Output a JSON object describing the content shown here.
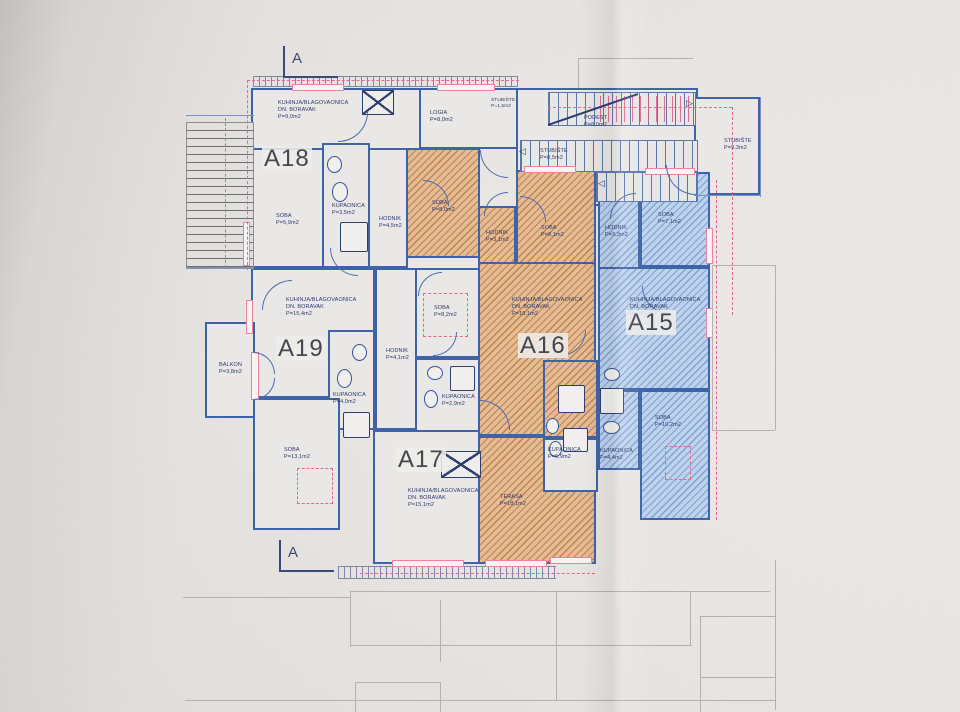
{
  "document": {
    "type": "architectural floor plan (photo of printed drawing)",
    "section_marker_top": "A",
    "section_marker_bottom": "A",
    "apartment_ids": [
      "A15",
      "A16",
      "A17",
      "A18",
      "A19"
    ]
  },
  "colors": {
    "wall": "#3f63a8",
    "line": "#4a6fae",
    "orange_fill": "#e4bd96",
    "orange_stripe": "#c4824f",
    "blue_fill": "#bfd2ec",
    "blue_stripe": "#7fa3d2",
    "pink": "#e8849f",
    "text": "#2c3a6e",
    "big_label": "#43474e",
    "paper": "#eae7e4"
  },
  "plan": {
    "rooms": [
      {
        "n": "a18-kuhinja",
        "x": 251,
        "y": 88,
        "w": 170,
        "h": 62,
        "f": "w"
      },
      {
        "n": "logia",
        "x": 419,
        "y": 88,
        "w": 100,
        "h": 61,
        "f": "w"
      },
      {
        "n": "a18-soba",
        "x": 251,
        "y": 148,
        "w": 73,
        "h": 120,
        "f": "w"
      },
      {
        "n": "a18-kupaonica",
        "x": 322,
        "y": 143,
        "w": 48,
        "h": 125,
        "f": "w"
      },
      {
        "n": "a18-hodnik",
        "x": 368,
        "y": 148,
        "w": 40,
        "h": 120,
        "f": "w"
      },
      {
        "n": "stair-hall",
        "x": 516,
        "y": 88,
        "w": 182,
        "h": 118,
        "f": "w"
      },
      {
        "n": "stubiste-right",
        "x": 694,
        "y": 97,
        "w": 66,
        "h": 98,
        "f": "w"
      },
      {
        "n": "soba-8-0",
        "x": 406,
        "y": 148,
        "w": 74,
        "h": 110,
        "f": "o"
      },
      {
        "n": "a16-hodnik",
        "x": 478,
        "y": 206,
        "w": 38,
        "h": 86,
        "f": "o"
      },
      {
        "n": "a16-soba",
        "x": 516,
        "y": 170,
        "w": 80,
        "h": 102,
        "f": "o"
      },
      {
        "n": "a16-kuhinja",
        "x": 478,
        "y": 262,
        "w": 118,
        "h": 174,
        "f": "o"
      },
      {
        "n": "a16-kupaonica",
        "x": 543,
        "y": 360,
        "w": 55,
        "h": 78,
        "f": "o"
      },
      {
        "n": "terasa",
        "x": 478,
        "y": 436,
        "w": 118,
        "h": 128,
        "f": "o"
      },
      {
        "n": "a15-hodnik",
        "x": 598,
        "y": 190,
        "w": 42,
        "h": 100,
        "f": "b"
      },
      {
        "n": "a15-soba-7-1",
        "x": 640,
        "y": 172,
        "w": 70,
        "h": 95,
        "f": "b"
      },
      {
        "n": "a15-kuhinja",
        "x": 598,
        "y": 267,
        "w": 112,
        "h": 123,
        "f": "b"
      },
      {
        "n": "a15-kupaonica",
        "x": 598,
        "y": 390,
        "w": 42,
        "h": 80,
        "f": "b"
      },
      {
        "n": "a15-soba-10-2",
        "x": 640,
        "y": 390,
        "w": 70,
        "h": 130,
        "f": "b"
      },
      {
        "n": "a19-kuhinja",
        "x": 251,
        "y": 268,
        "w": 124,
        "h": 130,
        "f": "w"
      },
      {
        "n": "a19-kupaonica",
        "x": 328,
        "y": 330,
        "w": 47,
        "h": 100,
        "f": "w"
      },
      {
        "n": "a19-soba",
        "x": 253,
        "y": 398,
        "w": 87,
        "h": 132,
        "f": "w"
      },
      {
        "n": "balkon",
        "x": 205,
        "y": 322,
        "w": 50,
        "h": 96,
        "f": "w"
      },
      {
        "n": "a17-hodnik",
        "x": 375,
        "y": 268,
        "w": 42,
        "h": 162,
        "f": "w"
      },
      {
        "n": "a17-soba",
        "x": 415,
        "y": 268,
        "w": 65,
        "h": 90,
        "f": "w"
      },
      {
        "n": "a17-kupaonica",
        "x": 415,
        "y": 358,
        "w": 65,
        "h": 82,
        "f": "w"
      },
      {
        "n": "a17-kuhinja",
        "x": 373,
        "y": 430,
        "w": 107,
        "h": 134,
        "f": "w"
      },
      {
        "n": "kupaonica-5-9",
        "x": 543,
        "y": 438,
        "w": 55,
        "h": 54,
        "f": "w"
      }
    ],
    "stairs": [
      {
        "n": "stair-flight-top",
        "x": 548,
        "y": 92,
        "w": 148,
        "h": 34,
        "d": "v"
      },
      {
        "n": "stair-flight-mid",
        "x": 520,
        "y": 140,
        "w": 178,
        "h": 32,
        "d": "v"
      },
      {
        "n": "stair-flight-low",
        "x": 596,
        "y": 172,
        "w": 102,
        "h": 30,
        "d": "v"
      },
      {
        "n": "exterior-stairs",
        "x": 186,
        "y": 122,
        "w": 68,
        "h": 146,
        "d": "h"
      }
    ],
    "red_treads": [
      {
        "n": "roof-stair-dashed",
        "x": 600,
        "y": 96,
        "w": 92,
        "h": 26
      }
    ],
    "tick_bands": [
      {
        "n": "top-parapet",
        "x": 253,
        "y": 76,
        "w": 265,
        "h": 11
      },
      {
        "n": "bottom-railing",
        "x": 338,
        "y": 566,
        "w": 218,
        "h": 13
      }
    ],
    "windows": [
      {
        "x": 292,
        "y": 84,
        "w": 52,
        "h": 7
      },
      {
        "x": 437,
        "y": 84,
        "w": 58,
        "h": 7
      },
      {
        "x": 243,
        "y": 222,
        "w": 7,
        "h": 44
      },
      {
        "x": 246,
        "y": 300,
        "w": 7,
        "h": 34
      },
      {
        "x": 251,
        "y": 352,
        "w": 8,
        "h": 48
      },
      {
        "x": 524,
        "y": 166,
        "w": 52,
        "h": 7
      },
      {
        "x": 645,
        "y": 168,
        "w": 50,
        "h": 7
      },
      {
        "x": 706,
        "y": 228,
        "w": 7,
        "h": 36
      },
      {
        "x": 706,
        "y": 308,
        "w": 7,
        "h": 30
      },
      {
        "x": 485,
        "y": 560,
        "w": 62,
        "h": 7
      },
      {
        "x": 550,
        "y": 557,
        "w": 42,
        "h": 7
      },
      {
        "x": 392,
        "y": 560,
        "w": 72,
        "h": 7
      }
    ],
    "dashed_rects": [
      {
        "n": "soba-8-2-outline",
        "x": 423,
        "y": 293,
        "w": 45,
        "h": 44
      },
      {
        "n": "soba-13-1-outline",
        "x": 297,
        "y": 468,
        "w": 36,
        "h": 36
      },
      {
        "n": "soba-10-2-outline",
        "x": 665,
        "y": 446,
        "w": 26,
        "h": 34
      }
    ],
    "dashed_lines": [
      {
        "o": "h",
        "x": 247,
        "y": 80,
        "l": 272
      },
      {
        "o": "v",
        "x": 247,
        "y": 80,
        "l": 190
      },
      {
        "o": "h",
        "x": 548,
        "y": 107,
        "l": 184
      },
      {
        "o": "v",
        "x": 732,
        "y": 107,
        "l": 208
      },
      {
        "o": "v",
        "x": 225,
        "y": 118,
        "l": 150
      },
      {
        "o": "h",
        "x": 360,
        "y": 573,
        "l": 235
      },
      {
        "o": "v",
        "x": 716,
        "y": 180,
        "l": 340
      }
    ],
    "fixtures": [
      {
        "t": "e",
        "x": 327,
        "y": 156,
        "w": 15,
        "h": 17
      },
      {
        "t": "e",
        "x": 332,
        "y": 182,
        "w": 16,
        "h": 20
      },
      {
        "t": "r",
        "x": 340,
        "y": 222,
        "w": 28,
        "h": 30
      },
      {
        "t": "e",
        "x": 352,
        "y": 344,
        "w": 15,
        "h": 17
      },
      {
        "t": "e",
        "x": 337,
        "y": 369,
        "w": 15,
        "h": 19
      },
      {
        "t": "r",
        "x": 343,
        "y": 412,
        "w": 27,
        "h": 26
      },
      {
        "t": "e",
        "x": 427,
        "y": 366,
        "w": 16,
        "h": 14
      },
      {
        "t": "e",
        "x": 424,
        "y": 390,
        "w": 14,
        "h": 18
      },
      {
        "t": "r",
        "x": 450,
        "y": 366,
        "w": 25,
        "h": 25
      },
      {
        "t": "r",
        "x": 558,
        "y": 385,
        "w": 27,
        "h": 28
      },
      {
        "t": "e",
        "x": 546,
        "y": 418,
        "w": 13,
        "h": 16
      },
      {
        "t": "e",
        "x": 549,
        "y": 441,
        "w": 13,
        "h": 16
      },
      {
        "t": "r",
        "x": 563,
        "y": 428,
        "w": 25,
        "h": 24
      },
      {
        "t": "e",
        "x": 604,
        "y": 368,
        "w": 16,
        "h": 13
      },
      {
        "t": "r",
        "x": 600,
        "y": 388,
        "w": 24,
        "h": 26
      },
      {
        "t": "e",
        "x": 603,
        "y": 421,
        "w": 17,
        "h": 13
      }
    ],
    "xboxes": [
      {
        "n": "shaft-top",
        "x": 362,
        "y": 90,
        "w": 32,
        "h": 25
      },
      {
        "n": "shaft-a17",
        "x": 441,
        "y": 451,
        "w": 40,
        "h": 27
      }
    ],
    "arcs": [
      {
        "x": 338,
        "y": 112,
        "s": 30,
        "c": "br"
      },
      {
        "x": 480,
        "y": 150,
        "s": 28,
        "c": "bl"
      },
      {
        "x": 423,
        "y": 180,
        "s": 26,
        "c": "tr"
      },
      {
        "x": 484,
        "y": 192,
        "s": 24,
        "c": "tl"
      },
      {
        "x": 520,
        "y": 196,
        "s": 26,
        "c": "tr"
      },
      {
        "x": 610,
        "y": 193,
        "s": 26,
        "c": "tl"
      },
      {
        "x": 642,
        "y": 286,
        "s": 28,
        "c": "bl"
      },
      {
        "x": 262,
        "y": 280,
        "s": 30,
        "c": "tl"
      },
      {
        "x": 330,
        "y": 248,
        "s": 28,
        "c": "bl"
      },
      {
        "x": 418,
        "y": 272,
        "s": 24,
        "c": "tl"
      },
      {
        "x": 480,
        "y": 400,
        "s": 30,
        "c": "tr"
      },
      {
        "x": 560,
        "y": 330,
        "s": 26,
        "c": "br"
      },
      {
        "x": 433,
        "y": 332,
        "s": 24,
        "c": "br"
      },
      {
        "x": 666,
        "y": 165,
        "s": 30,
        "c": "bl"
      },
      {
        "x": 253,
        "y": 352,
        "s": 22,
        "c": "tr"
      },
      {
        "x": 253,
        "y": 378,
        "s": 22,
        "c": "br"
      }
    ],
    "diagonals": [
      {
        "x": 548,
        "y": 124,
        "w": 95,
        "r": -19
      }
    ],
    "labels": [
      {
        "t": [
          "KUHINJA/BLAGOVAONICA",
          "DN. BORAVAK",
          "P=9,0m2"
        ],
        "x": 278,
        "y": 100
      },
      {
        "t": [
          "LOGIA",
          "P=8,0m2"
        ],
        "x": 430,
        "y": 110
      },
      {
        "t": [
          "STUBIŠTE",
          "P=1,5m2"
        ],
        "x": 491,
        "y": 98,
        "fs": 4.8
      },
      {
        "t": [
          "PODEST",
          "P=8,0m2"
        ],
        "x": 584,
        "y": 115
      },
      {
        "t": [
          "STUBIŠTE",
          "P=8,5m2"
        ],
        "x": 540,
        "y": 148
      },
      {
        "t": [
          "STUBIŠTE",
          "P=9,3m2"
        ],
        "x": 724,
        "y": 138
      },
      {
        "t": [
          "SOBA",
          "P=5,9m2"
        ],
        "x": 276,
        "y": 213
      },
      {
        "t": [
          "KUPAONICA",
          "P=3,5m2"
        ],
        "x": 332,
        "y": 203
      },
      {
        "t": [
          "HODNIK",
          "P=4,5m2"
        ],
        "x": 379,
        "y": 216
      },
      {
        "t": [
          "SOBA",
          "P=8,0m2"
        ],
        "x": 432,
        "y": 200
      },
      {
        "t": [
          "HODNIK",
          "P=3,1m2"
        ],
        "x": 486,
        "y": 230
      },
      {
        "t": [
          "SOBA",
          "P=8,1m2"
        ],
        "x": 541,
        "y": 225
      },
      {
        "t": [
          "HODNIK",
          "P=3,3m2"
        ],
        "x": 605,
        "y": 225
      },
      {
        "t": [
          "SOBA",
          "P=7,1m2"
        ],
        "x": 658,
        "y": 212
      },
      {
        "t": [
          "KUHINJA/BLAGOVAONICA",
          "DN. BORAVAK",
          "P=15,4m2"
        ],
        "x": 286,
        "y": 297
      },
      {
        "t": [
          "BALKON",
          "P=3,8m2"
        ],
        "x": 219,
        "y": 362
      },
      {
        "t": [
          "KUPAONICA",
          "P=4,0m2"
        ],
        "x": 333,
        "y": 392
      },
      {
        "t": [
          "HODNIK",
          "P=4,1m2"
        ],
        "x": 386,
        "y": 348
      },
      {
        "t": [
          "SOBA",
          "P=8,2m2"
        ],
        "x": 434,
        "y": 305
      },
      {
        "t": [
          "KUHINJA/BLAGOVAONICA",
          "DN. BORAVAK",
          "P=15,1m2"
        ],
        "x": 512,
        "y": 297
      },
      {
        "t": [
          "KUHINJA/BLAGOVAONICA",
          "DN. BORAVAK",
          "P=15,1m2"
        ],
        "x": 630,
        "y": 297
      },
      {
        "t": [
          "KUPAONICA",
          "P=2,9m2"
        ],
        "x": 442,
        "y": 394
      },
      {
        "t": [
          "KUPAONICA",
          "P=5,9m2"
        ],
        "x": 548,
        "y": 447
      },
      {
        "t": [
          "KUPAONICA",
          "P=4,4m2"
        ],
        "x": 600,
        "y": 448
      },
      {
        "t": [
          "SOBA",
          "P=10,2m2"
        ],
        "x": 655,
        "y": 415
      },
      {
        "t": [
          "SOBA",
          "P=13,1m2"
        ],
        "x": 284,
        "y": 447
      },
      {
        "t": [
          "KUHINJA/BLAGOVAONICA",
          "DN. BORAVAK",
          "P=15,1m2"
        ],
        "x": 408,
        "y": 488
      },
      {
        "t": [
          "TERASA",
          "P=18,1m2"
        ],
        "x": 500,
        "y": 494
      },
      {
        "t": [
          "◁"
        ],
        "x": 519,
        "y": 146,
        "fs": 9
      },
      {
        "t": [
          "◁"
        ],
        "x": 598,
        "y": 178,
        "fs": 9
      },
      {
        "t": [
          "▷"
        ],
        "x": 686,
        "y": 98,
        "fs": 9
      }
    ],
    "big_labels": [
      {
        "t": "A18",
        "x": 262,
        "y": 146
      },
      {
        "t": "A19",
        "x": 276,
        "y": 336
      },
      {
        "t": "A16",
        "x": 518,
        "y": 333
      },
      {
        "t": "A15",
        "x": 626,
        "y": 310
      },
      {
        "t": "A17",
        "x": 396,
        "y": 447
      }
    ],
    "section_markers": [
      {
        "t": "A",
        "x": 292,
        "y": 50,
        "lx": 283,
        "ly": 76,
        "vx": 283,
        "vy": 46,
        "vh": 31
      },
      {
        "t": "A",
        "x": 288,
        "y": 544,
        "lx": 279,
        "ly": 570,
        "vx": 279,
        "vy": 540,
        "vh": 31
      }
    ],
    "faint_lines": [
      {
        "x": 350,
        "y": 591,
        "w": 420,
        "h": 1
      },
      {
        "x": 350,
        "y": 591,
        "w": 1,
        "h": 56
      },
      {
        "x": 440,
        "y": 600,
        "w": 1,
        "h": 62
      },
      {
        "x": 556,
        "y": 591,
        "w": 1,
        "h": 110
      },
      {
        "x": 690,
        "y": 591,
        "w": 1,
        "h": 54
      },
      {
        "x": 350,
        "y": 645,
        "w": 342,
        "h": 1
      },
      {
        "x": 700,
        "y": 616,
        "w": 76,
        "h": 1
      },
      {
        "x": 700,
        "y": 616,
        "w": 1,
        "h": 96
      },
      {
        "x": 775,
        "y": 560,
        "w": 1,
        "h": 150
      },
      {
        "x": 700,
        "y": 677,
        "w": 76,
        "h": 1
      },
      {
        "x": 185,
        "y": 700,
        "w": 590,
        "h": 1
      },
      {
        "x": 355,
        "y": 682,
        "w": 86,
        "h": 1
      },
      {
        "x": 355,
        "y": 682,
        "w": 1,
        "h": 30
      },
      {
        "x": 440,
        "y": 682,
        "w": 1,
        "h": 30
      },
      {
        "x": 712,
        "y": 265,
        "w": 63,
        "h": 1
      },
      {
        "x": 775,
        "y": 265,
        "w": 1,
        "h": 165
      },
      {
        "x": 712,
        "y": 265,
        "w": 1,
        "h": 165
      },
      {
        "x": 712,
        "y": 430,
        "w": 63,
        "h": 1
      },
      {
        "x": 183,
        "y": 597,
        "w": 168,
        "h": 1
      },
      {
        "x": 578,
        "y": 58,
        "w": 115,
        "h": 1
      },
      {
        "x": 578,
        "y": 58,
        "w": 1,
        "h": 30
      }
    ],
    "blue_lines": [
      {
        "x": 760,
        "y": 97,
        "w": 1,
        "h": 100
      },
      {
        "x": 694,
        "y": 195,
        "w": 67,
        "h": 1
      },
      {
        "x": 186,
        "y": 115,
        "w": 68,
        "h": 1
      },
      {
        "x": 186,
        "y": 268,
        "w": 68,
        "h": 1
      }
    ]
  }
}
